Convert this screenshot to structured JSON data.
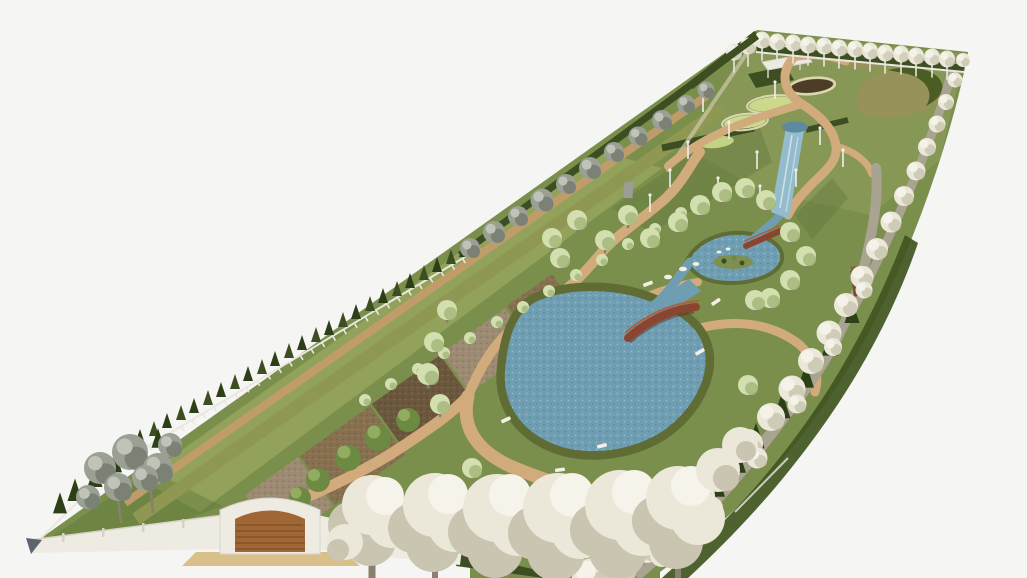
{
  "scene": {
    "type": "3d-landscape-render",
    "description": "Aerial 3D architectural rendering of a long narrow park plot on a white background, viewed in perspective from its near corner. The plot is bordered by dense rows of white blossoming trees on the right and near edges, a conifer hedge with a white fence and grey deciduous trees on the left edge, and an evenly spaced row of pale trees along the far edge. Inside are winding tan gravel paths, a large kidney-shaped pond with two wooden bridges and benches, a stream fed by a waterfall from a raised terrace with oval planting beds and a white pergola, tilled soil plots along the left side, and a walled entrance with a wooden gate at the near end."
  },
  "features": {
    "entrance": "white perimeter wall with arched wooden entrance gate and tan driveway apron",
    "water": [
      "large kidney-shaped pond",
      "upper stream pond with small island",
      "stream",
      "waterfall cascade from terrace",
      "terrace pool"
    ],
    "bridges_count": 2,
    "benches_count": 6,
    "tilled_plots_count": 5,
    "oval_planting_beds_count": 4,
    "far_row_trees_count": 15,
    "structures": [
      "white pergola slab on posts",
      "grey monument stone",
      "brown kiosk near right path"
    ],
    "vegetation": [
      "white blossom tree rows",
      "grey deciduous tree row",
      "dark conifer hedge",
      "light-green shrub row",
      "scattered pale-green park trees"
    ]
  },
  "colors": {
    "bg": "#f5f5f3",
    "lawn": "#7b8f4c",
    "lawn_far": "#909e5e",
    "lawn_light": "#a2af66",
    "lawn_dark": "#5d7338",
    "shadow_green": "#3f5520",
    "olive_strip": "#8f9852",
    "path_tan": "#d2ab7c",
    "path_tan_dark": "#c39c6b",
    "path_gray": "#a9a491",
    "path_light": "#cfc8ad",
    "soil_gray": "#9c8b72",
    "soil_brown": "#86704f",
    "soil_dark": "#6b573c",
    "water": "#6f9db2",
    "water_dark": "#5d8aa0",
    "water_light": "#93bccd",
    "shore": "#5f6c33",
    "island_green": "#7d9050",
    "hedge": "#3d4f22",
    "conifer": "#2c3f16",
    "tree_white": "#ebe8da",
    "tree_white_shade": "#c9c5b0",
    "tree_white_hi": "#f6f4ea",
    "tree_gray": "#9ba095",
    "tree_gray_dark": "#7b8275",
    "tree_gray_hi": "#c0c3b8",
    "tree_pale": "#d3dfae",
    "tree_pale_dark": "#a4b97d",
    "tree_green": "#6d8a43",
    "tree_green_hi": "#93ad60",
    "trunk": "#8a8070",
    "trunk_white": "#e9e7df",
    "wall": "#edebe2",
    "wall_shade": "#d6d3c6",
    "wall_end": "#5a6570",
    "gate_wood": "#a06634",
    "gate_wood_dark": "#7c4e26",
    "bridge": "#8a4530",
    "bridge_rail": "#aa6240",
    "bench": "#f2f0e6",
    "stone": "#9c9c96",
    "pole": "#efefe9",
    "oval_dark": "#4c3c28",
    "oval_green": "#ccd98c",
    "oval_ring": "#ddd6b2",
    "mound": "#97925a",
    "apron": "#d9c08b",
    "kiosk": "#7a4a30"
  }
}
